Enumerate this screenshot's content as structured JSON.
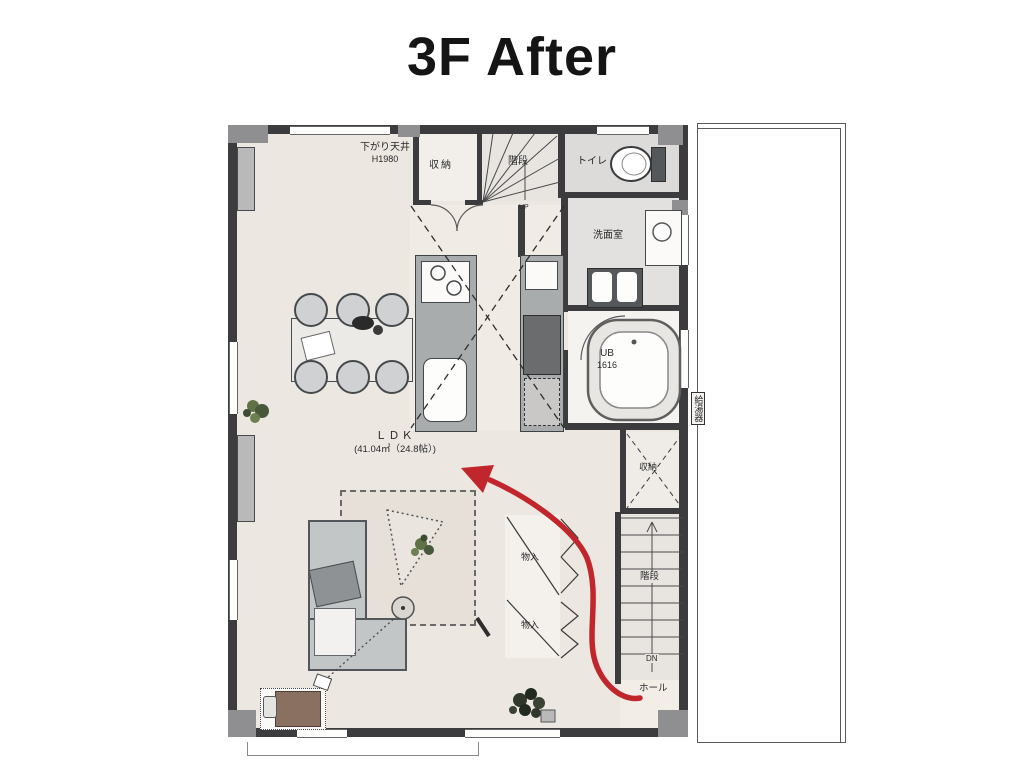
{
  "title": "3F After",
  "plan": {
    "labels": {
      "dropped_ceiling": "下がり天井",
      "dropped_ceiling_h": "H1980",
      "storage_top": "収納",
      "stairs_top": "階段",
      "up": "UP",
      "toilet": "トイレ",
      "washroom": "洗面室",
      "bath": "UB",
      "bath_size": "1616",
      "water_heater": "給湯器",
      "storage_right": "収納",
      "closet_upper": "物入",
      "closet_lower": "物入",
      "stairs_bottom": "階段",
      "down": "DN",
      "hall": "ホール",
      "ldk": "ＬＤＫ",
      "ldk_area": "(41.04㎡（24.8帖）)"
    },
    "colors": {
      "arrow": "#c0262c",
      "wall": "#3c3c3e",
      "floor": "#ece7e1"
    }
  }
}
